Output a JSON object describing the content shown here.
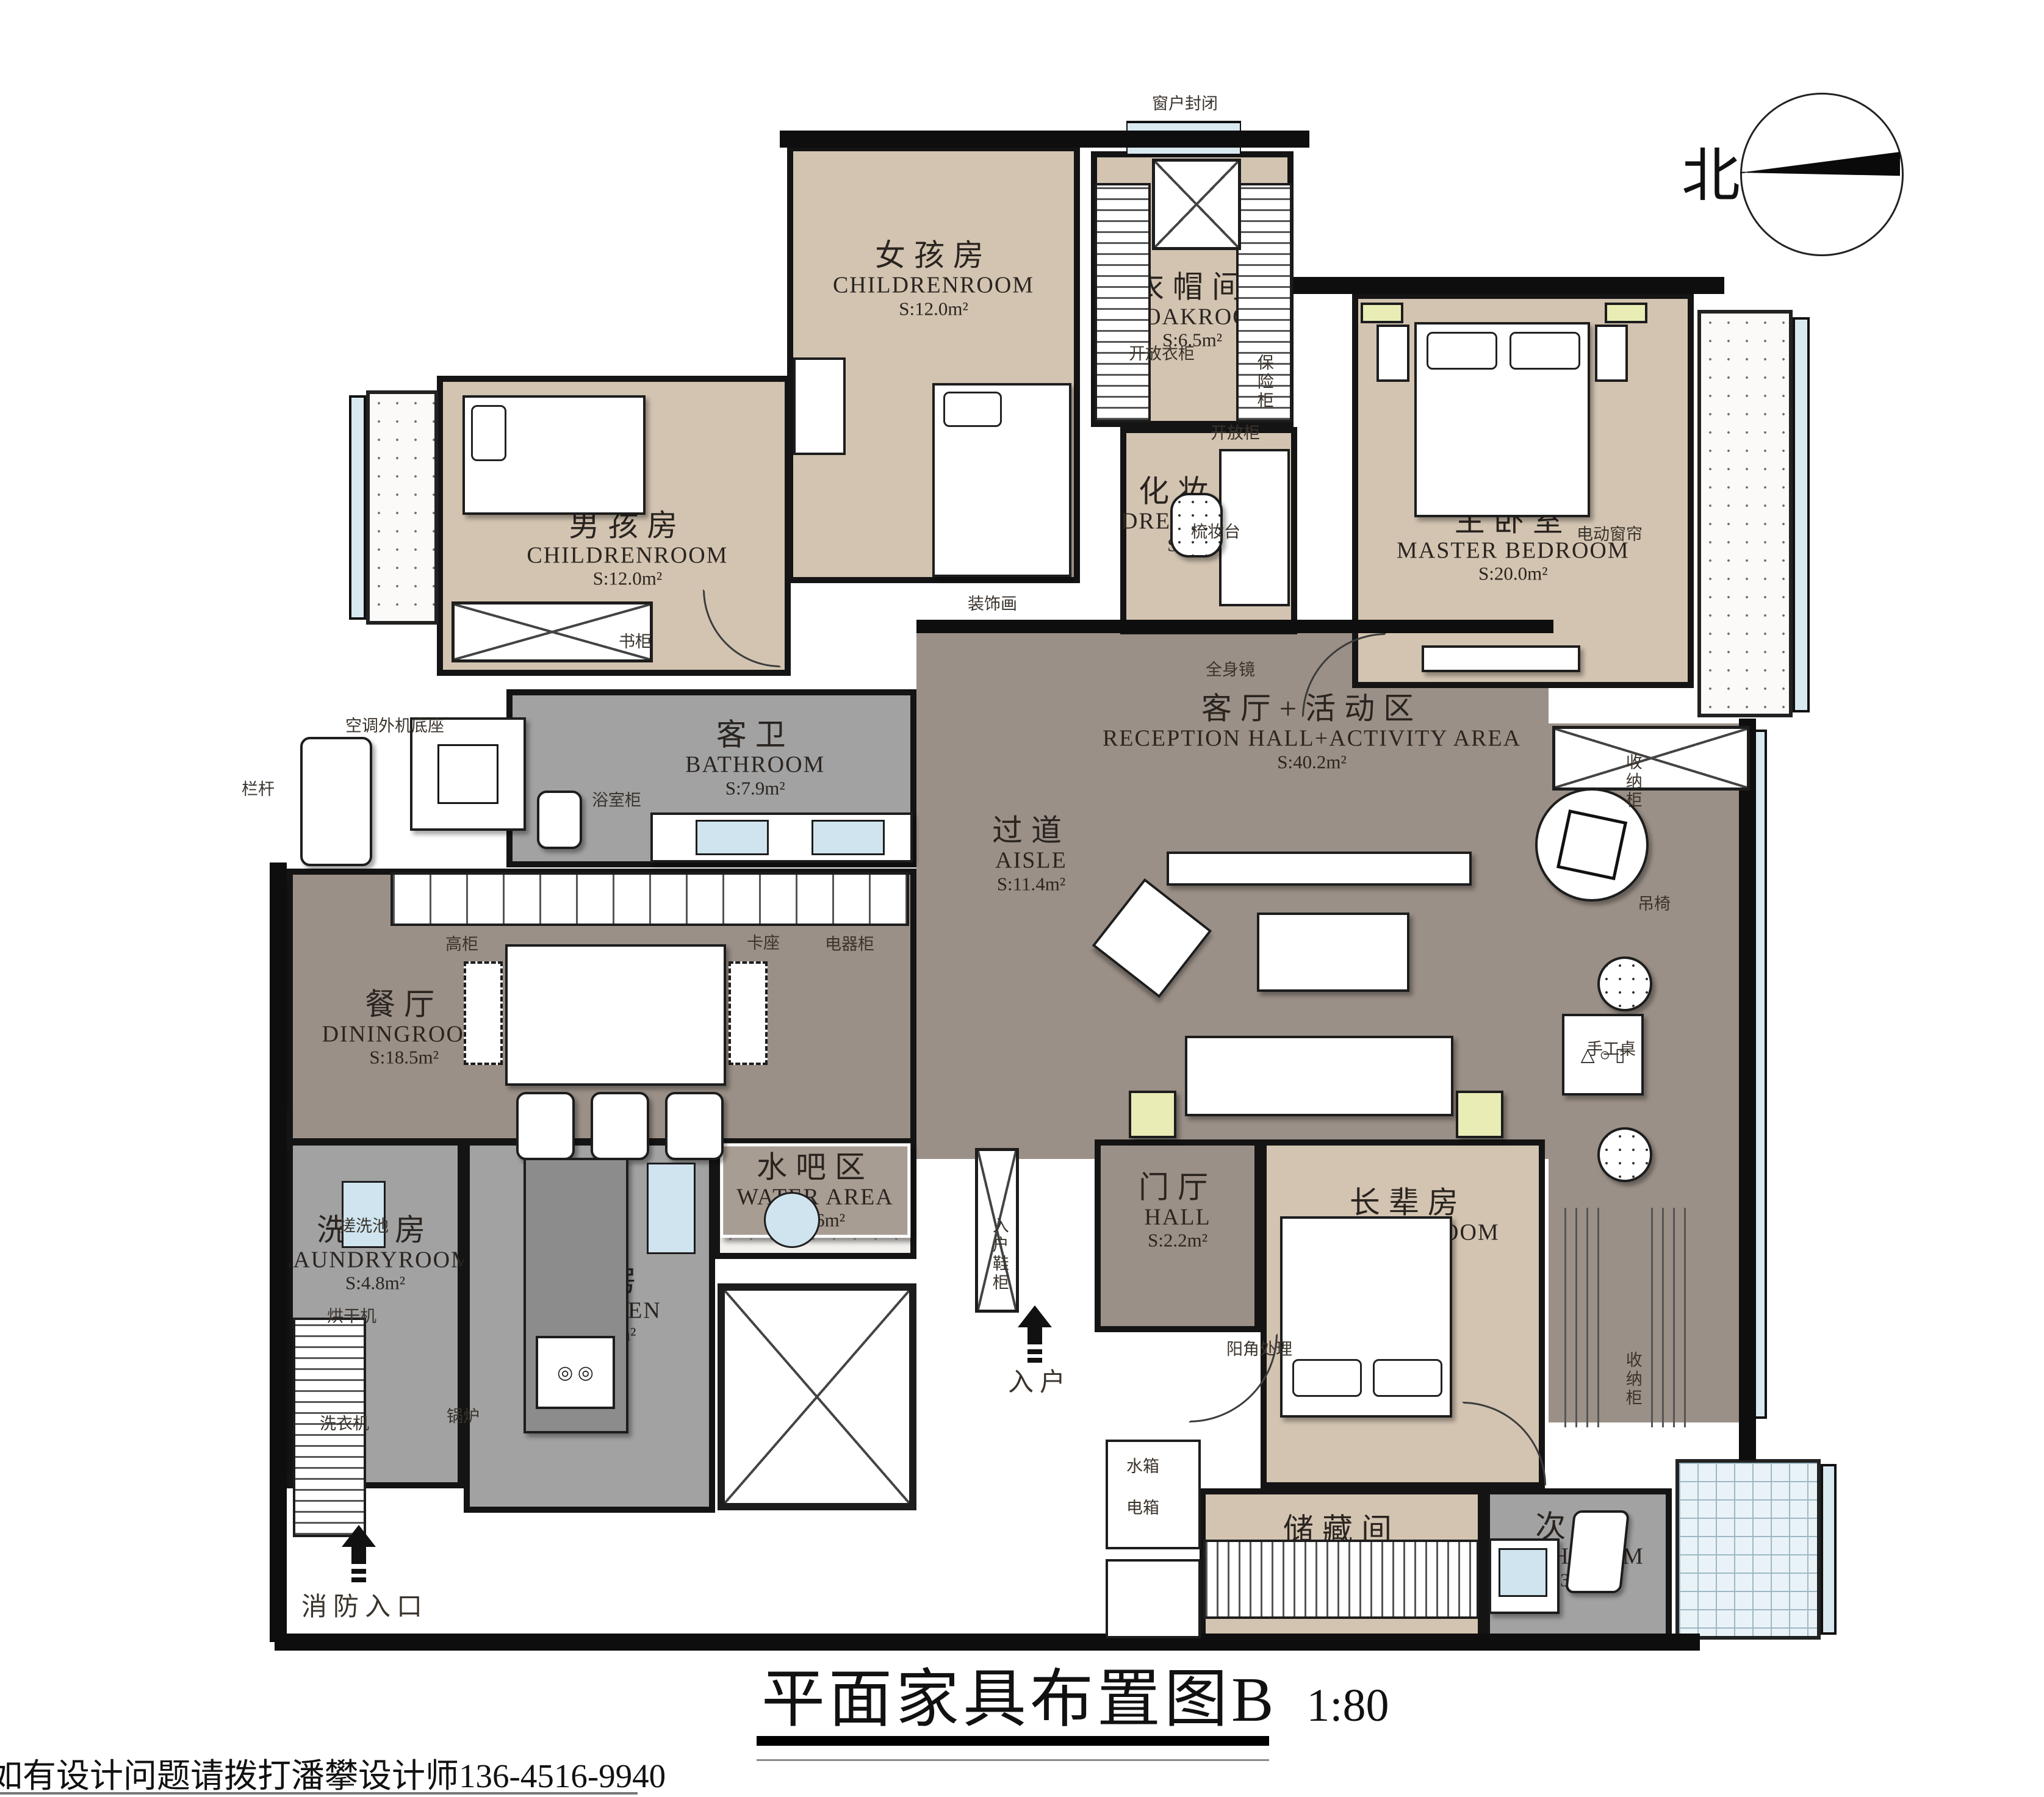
{
  "title": {
    "text": "平面家具布置图B",
    "scale": "1:80"
  },
  "footer": {
    "contact": "如有设计问题请拨打潘攀设计师136-4516-9940"
  },
  "compass": {
    "label": "北"
  },
  "colors": {
    "beige": "#d3c4b1",
    "gray": "#a2a2a2",
    "taupe": "#9b9087",
    "wall": "#0e0e0e",
    "window": "#d9e9f0",
    "accent_yellow": "#e9edb5"
  },
  "rooms": [
    {
      "id": "girls",
      "name_cn": "女孩房",
      "name_en": "CHILDRENROOM",
      "area": "S:12.0m²"
    },
    {
      "id": "cloak",
      "name_cn": "衣帽间",
      "name_en": "CLOAKROOM",
      "area": "S:6.5m²"
    },
    {
      "id": "dress",
      "name_cn": "化妆间",
      "name_en": "DRESSROOM",
      "area": "S:3.7m²"
    },
    {
      "id": "master",
      "name_cn": "主卧室",
      "name_en": "MASTER BEDROOM",
      "area": "S:20.0m²"
    },
    {
      "id": "boys",
      "name_cn": "男孩房",
      "name_en": "CHILDRENROOM",
      "area": "S:12.0m²"
    },
    {
      "id": "gbath",
      "name_cn": "客卫",
      "name_en": "BATHROOM",
      "area": "S:7.9m²"
    },
    {
      "id": "aisle",
      "name_cn": "过道",
      "name_en": "AISLE",
      "area": "S:11.4m²"
    },
    {
      "id": "living",
      "name_cn": "客厅+活动区",
      "name_en": "RECEPTION HALL+ACTIVITY AREA",
      "area": "S:40.2m²"
    },
    {
      "id": "dining",
      "name_cn": "餐厅",
      "name_en": "DININGROOM",
      "area": "S:18.5m²"
    },
    {
      "id": "water",
      "name_cn": "水吧区",
      "name_en": "WATER AREA",
      "area": "S:2.6m²"
    },
    {
      "id": "hall",
      "name_cn": "门厅",
      "name_en": "HALL",
      "area": "S:2.2m²"
    },
    {
      "id": "old",
      "name_cn": "长辈房",
      "name_en": "OLD BEDROOM",
      "area": "S:11.6m²"
    },
    {
      "id": "laundry",
      "name_cn": "洗衣房",
      "name_en": "LAUNDRYROOM",
      "area": "S:4.8m²"
    },
    {
      "id": "kitchen",
      "name_cn": "厨房",
      "name_en": "KITCHEN",
      "area": "S:7.6m²"
    },
    {
      "id": "storage",
      "name_cn": "储藏间",
      "name_en": "HOVEL",
      "area": "S:4.9m²"
    },
    {
      "id": "bath2",
      "name_cn": "次卫",
      "name_en": "BATHROOM",
      "area": "S:3.3m²"
    }
  ],
  "annotations": [
    {
      "id": "window_sealed",
      "text": "窗户封闭"
    },
    {
      "id": "open_wardrobe",
      "text": "开放衣柜"
    },
    {
      "id": "safe",
      "text": "保险柜"
    },
    {
      "id": "open_cabinet",
      "text": "开放柜"
    },
    {
      "id": "dresser",
      "text": "梳妆台"
    },
    {
      "id": "electric_curtain",
      "text": "电动窗帘"
    },
    {
      "id": "deco_painting",
      "text": "装饰画"
    },
    {
      "id": "full_mirror",
      "text": "全身镜"
    },
    {
      "id": "bookcase",
      "text": "书柜"
    },
    {
      "id": "ac_base",
      "text": "空调外机底座"
    },
    {
      "id": "railing",
      "text": "栏杆"
    },
    {
      "id": "bath_cabinet",
      "text": "浴室柜"
    },
    {
      "id": "tall_cabinet",
      "text": "高柜"
    },
    {
      "id": "booth",
      "text": "卡座"
    },
    {
      "id": "appliance_cabinet",
      "text": "电器柜"
    },
    {
      "id": "storage_cab1",
      "text": "收纳柜"
    },
    {
      "id": "hanging_chair",
      "text": "吊椅"
    },
    {
      "id": "craft_table",
      "text": "手工桌"
    },
    {
      "id": "storage_cab2",
      "text": "收纳柜"
    },
    {
      "id": "scrub_sink",
      "text": "搓洗池"
    },
    {
      "id": "dryer",
      "text": "烘干机"
    },
    {
      "id": "washer",
      "text": "洗衣机"
    },
    {
      "id": "boiler",
      "text": "锅炉"
    },
    {
      "id": "entry_shoe",
      "text": "入户鞋柜"
    },
    {
      "id": "entry",
      "text": "入户"
    },
    {
      "id": "corner",
      "text": "阳角处理"
    },
    {
      "id": "tank",
      "text": "水箱"
    },
    {
      "id": "ebox",
      "text": "电箱"
    },
    {
      "id": "fire",
      "text": "消防入口"
    }
  ]
}
